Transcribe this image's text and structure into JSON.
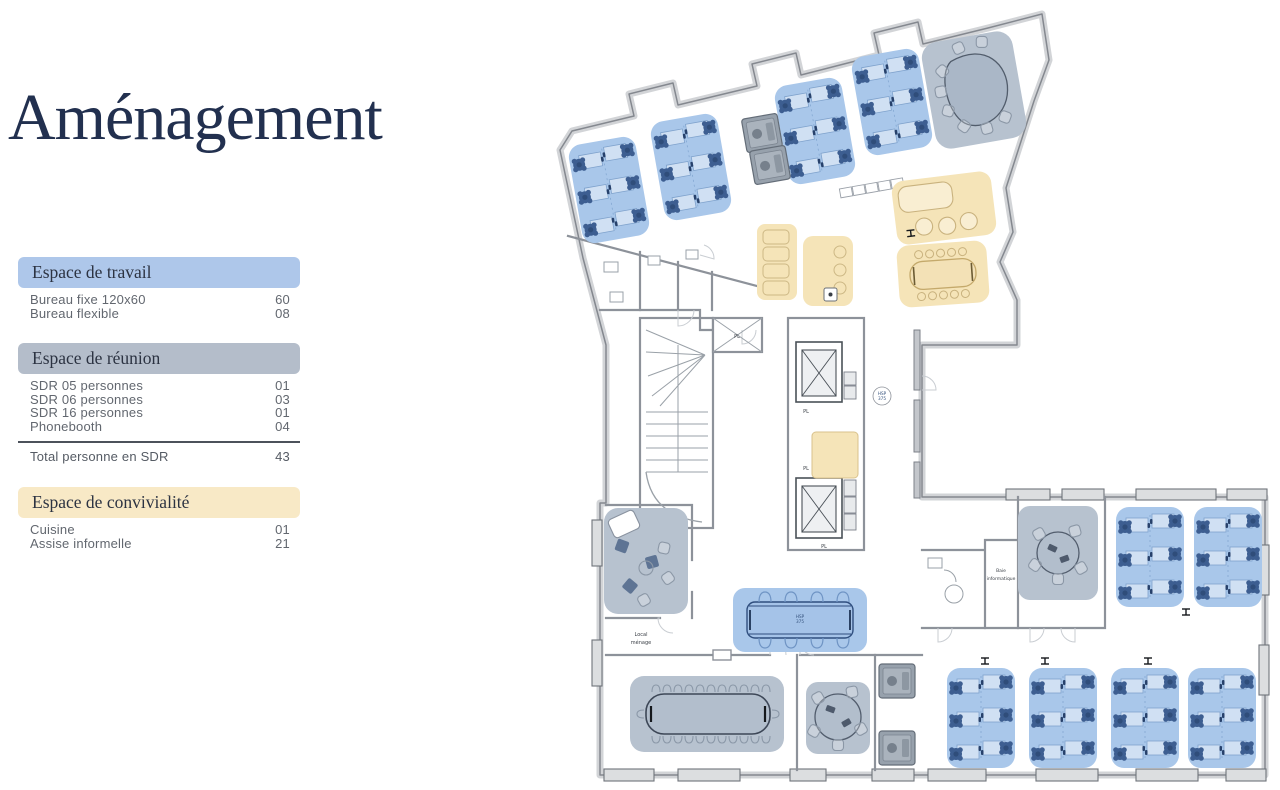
{
  "title": "Aménagement",
  "colors": {
    "work": "#a9c7ea",
    "meeting": "#b7c2cf",
    "social": "#f5e4b8",
    "chair": "#3d5e91",
    "accent_title": "#22304f",
    "header_work": "#aec7ea",
    "header_meeting": "#b4bdca",
    "header_social": "#f8e9c6"
  },
  "legend": {
    "sections": [
      {
        "header": "Espace de travail",
        "items": [
          {
            "label": "Bureau fixe 120x60",
            "value": "60"
          },
          {
            "label": "Bureau flexible",
            "value": "08"
          }
        ]
      },
      {
        "header": "Espace de réunion",
        "items": [
          {
            "label": "SDR 05 personnes",
            "value": "01"
          },
          {
            "label": "SDR 06 personnes",
            "value": "03"
          },
          {
            "label": "SDR 16 personnes",
            "value": "01"
          },
          {
            "label": "Phonebooth",
            "value": "04"
          }
        ],
        "total": {
          "label": "Total personne en SDR",
          "value": "43"
        }
      },
      {
        "header": "Espace de convivialité",
        "items": [
          {
            "label": "Cuisine",
            "value": "01"
          },
          {
            "label": "Assise informelle",
            "value": "21"
          }
        ]
      }
    ]
  },
  "plan": {
    "labels": {
      "pl": "PL",
      "hsp_line1": "HSP",
      "hsp_line2": "375",
      "table_tag_line1": "HSP",
      "table_tag_line2": "375",
      "local_menage_line1": "Local",
      "local_menage_line2": "ménage",
      "baie_line1": "Baie",
      "baie_line2": "informatique"
    }
  }
}
